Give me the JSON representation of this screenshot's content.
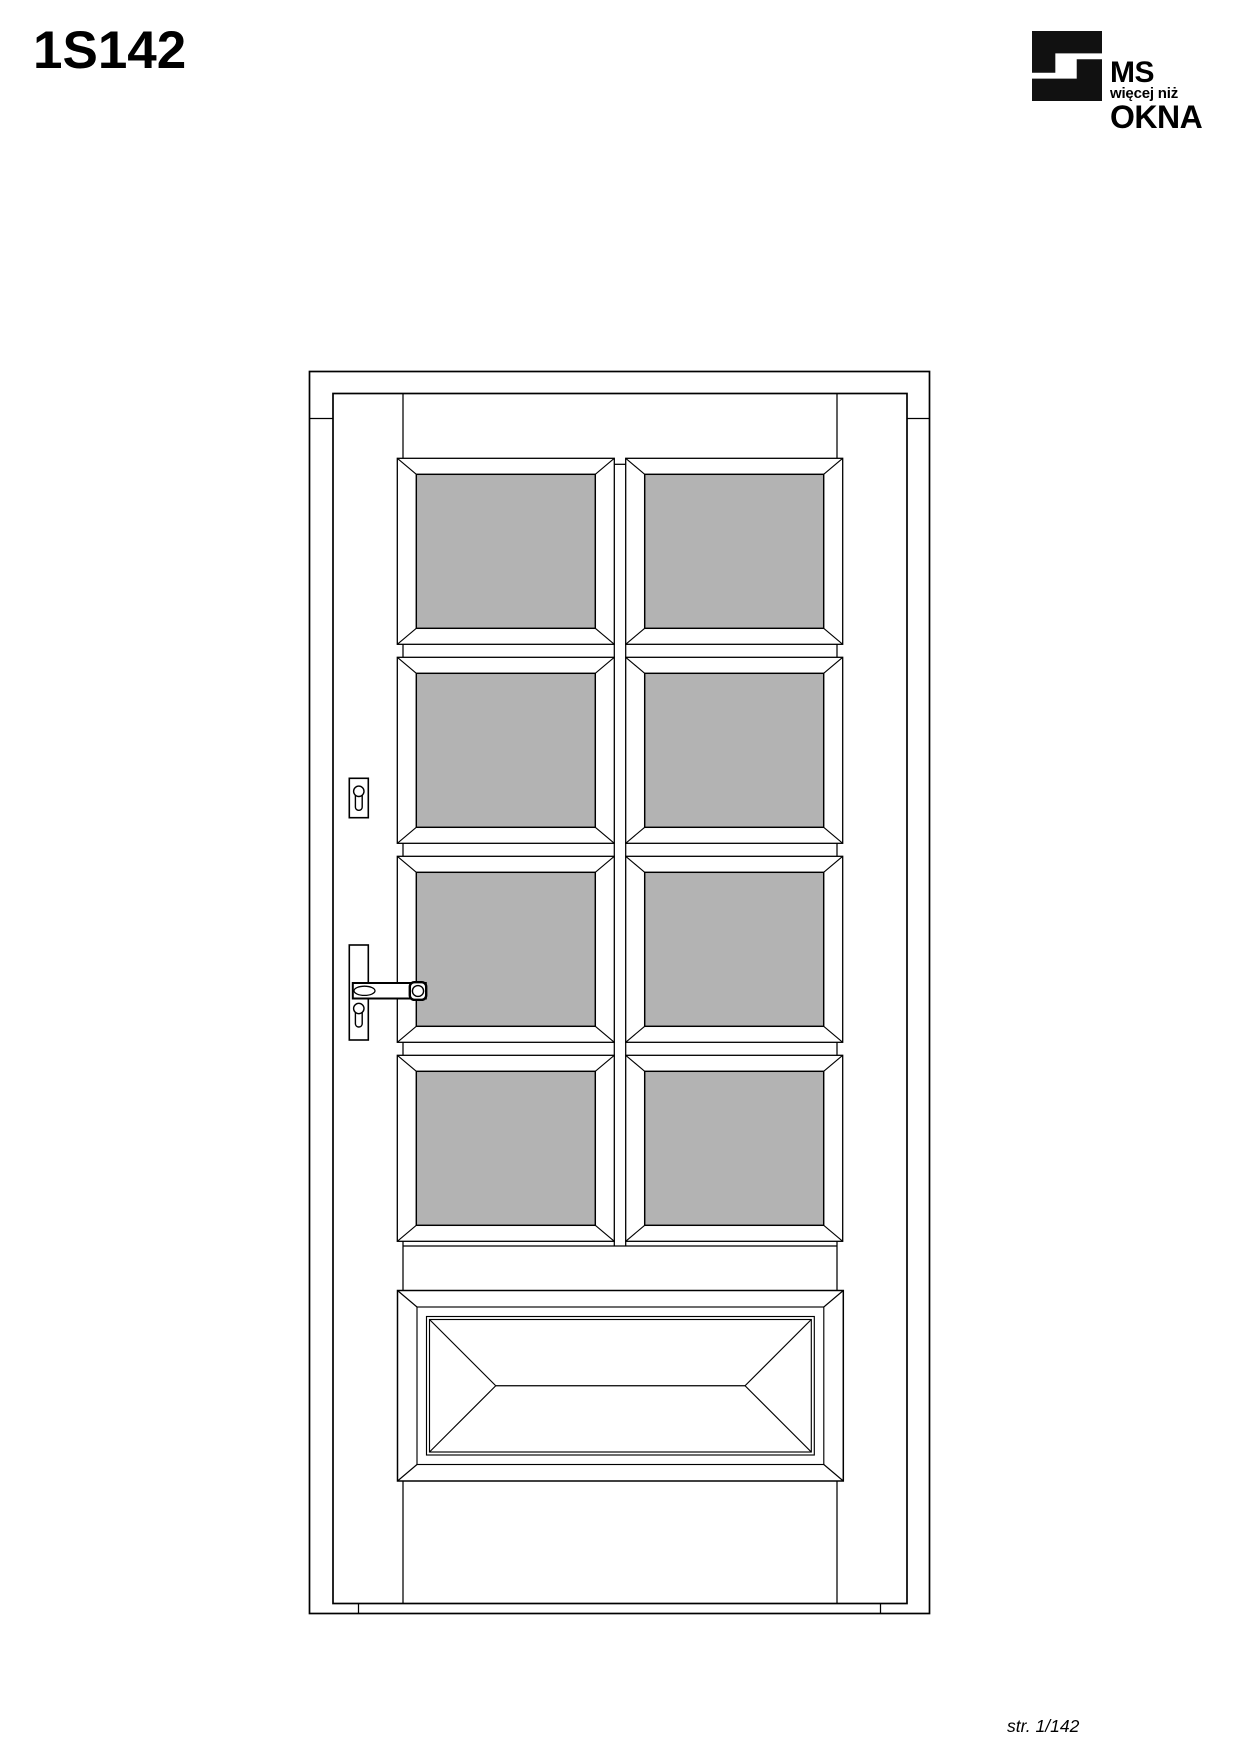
{
  "page": {
    "title": "1S142",
    "page_number": "str. 1/142",
    "background": "#ffffff"
  },
  "logo": {
    "line1": "MS",
    "line2": "więcej niż",
    "line3": "OKNA",
    "color": "#111111"
  },
  "drawing": {
    "stroke": "#000000",
    "glass_fill": "#b3b3b3",
    "panel_fill": "#ffffff",
    "frame": {
      "x": 309.5,
      "y": 371.5,
      "w": 620,
      "h": 1242,
      "sw": 1.7
    },
    "leaf": {
      "x": 333,
      "y": 393.5,
      "w": 574,
      "h": 1210,
      "sw": 1.7
    },
    "segments": [
      [
        309.5,
        418.5,
        333,
        418.5
      ],
      [
        907,
        418.5,
        929.5,
        418.5
      ],
      [
        358.5,
        1603.5,
        358.5,
        1613.5
      ],
      [
        880.5,
        1603.5,
        880.5,
        1613.5
      ],
      [
        403,
        393.5,
        403,
        458.3
      ],
      [
        403,
        644.3,
        403,
        657.3
      ],
      [
        403,
        843.3,
        403,
        856.3
      ],
      [
        403,
        1042.3,
        403,
        1055.3
      ],
      [
        403,
        1241.3,
        403,
        1290.5
      ],
      [
        403,
        1481,
        403,
        1603.5
      ],
      [
        837,
        393.5,
        837,
        458.3
      ],
      [
        837,
        644.3,
        837,
        657.3
      ],
      [
        837,
        843.3,
        837,
        856.3
      ],
      [
        837,
        1042.3,
        837,
        1055.3
      ],
      [
        837,
        1241.3,
        837,
        1290.5
      ],
      [
        837,
        1481,
        837,
        1603.5
      ],
      [
        614.3,
        464.3,
        625.7,
        464.3
      ],
      [
        614.3,
        644.3,
        614.3,
        657.3
      ],
      [
        625.7,
        644.3,
        625.7,
        657.3
      ],
      [
        614.3,
        843.3,
        614.3,
        856.3
      ],
      [
        625.7,
        843.3,
        625.7,
        856.3
      ],
      [
        614.3,
        1042.3,
        614.3,
        1055.3
      ],
      [
        625.7,
        1042.3,
        625.7,
        1055.3
      ],
      [
        614.3,
        1241.3,
        614.3,
        1246
      ],
      [
        625.7,
        1241.3,
        625.7,
        1246
      ],
      [
        403,
        1246,
        837,
        1246
      ]
    ],
    "glass_panels": {
      "w": 217,
      "h": 186,
      "inset_x": 19,
      "inset_y": 16,
      "positions": [
        [
          397.3,
          458.3
        ],
        [
          625.7,
          458.3
        ],
        [
          397.3,
          657.3
        ],
        [
          625.7,
          657.3
        ],
        [
          397.3,
          856.3
        ],
        [
          625.7,
          856.3
        ],
        [
          397.3,
          1055.3
        ],
        [
          625.7,
          1055.3
        ]
      ]
    },
    "bottom_panel": {
      "x": 397.5,
      "y": 1290.5,
      "w": 445.8,
      "h": 190.5,
      "bevel_x": 19.5,
      "bevel_y": 16.5,
      "inset2": 9.5,
      "inset3": 3
    },
    "hardware": {
      "escutcheon_plate": {
        "x": 349.3,
        "y": 778.3,
        "w": 19,
        "h": 39.4
      },
      "escutcheon_slot": {
        "x": 355.4,
        "y": 789,
        "w": 6.8,
        "h": 21.3,
        "r": 3.2
      },
      "escutcheon_circle": {
        "cx": 358.8,
        "cy": 791.3,
        "r": 5.2
      },
      "handle_backplate": {
        "x": 349.3,
        "y": 945,
        "w": 19,
        "h": 95
      },
      "keyhole_slot": {
        "x": 355.4,
        "y": 1006,
        "w": 6.8,
        "h": 21,
        "r": 3.2
      },
      "keyhole_circle": {
        "cx": 358.8,
        "cy": 1008.5,
        "r": 5.2
      },
      "handle_bar": {
        "x": 352.8,
        "y": 983,
        "w": 73,
        "h": 15.5
      },
      "handle_grip": {
        "cx": 364.5,
        "cy": 990.8,
        "rx": 10.5,
        "ry": 4.6
      },
      "handle_boss": {
        "x": 409.8,
        "y": 982.2,
        "w": 16.4,
        "h": 17.6,
        "r": 4.5
      },
      "handle_boss_inner": {
        "cx": 418,
        "cy": 991,
        "rx": 5.6,
        "ry": 5.4
      }
    }
  }
}
